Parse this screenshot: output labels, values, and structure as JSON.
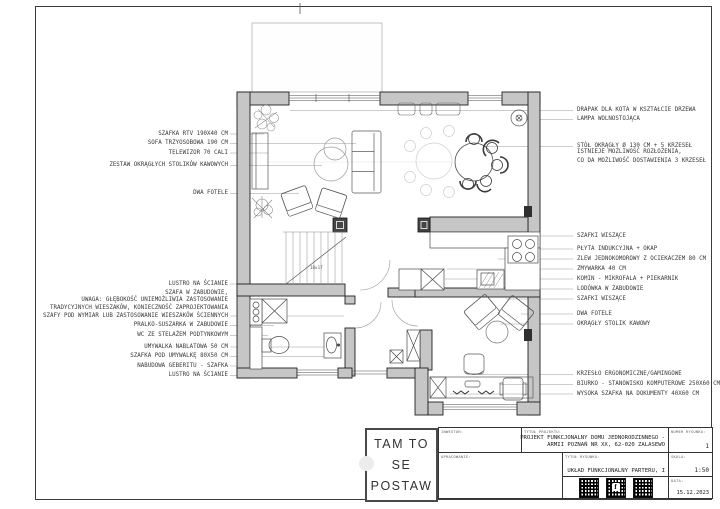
{
  "drawing": {
    "logo": [
      "TAM TO",
      "SE",
      "POSTAW"
    ],
    "stairs_note": "18x17",
    "qr_glyph": "f",
    "title_block": {
      "investor_label": "INWESTOR:",
      "development_label": "OPRACOWANIE:",
      "project_title_label": "TYTUŁ PROJEKTU:",
      "project_title_line1": "PROJEKT FUNKCJONALNY DOMU JEDNORODZINNEGO -",
      "project_title_line2": "ARMII POZNAŃ NR XX, 62-020 ZALASEWO",
      "drawing_title_label": "TYTUŁ RYSUNKU:",
      "drawing_title": "UKŁAD FUNKCJONALNY PARTERU, I",
      "number_label": "NUMER RYSUNKU:",
      "number": "1",
      "scale_label": "SKALA:",
      "scale": "1:50",
      "date_label": "DATA:",
      "date": "15.12.2023"
    },
    "annotations_left": [
      "SZAFKA RTV 190X40 CM",
      "SOFA TRZYOSOBOWA 190 CM",
      "TELEWIZOR 70 CALI",
      "ZESTAW OKRĄGŁYCH STOLIKÓW KAWOWYCH",
      "DWA FOTELE",
      "LUSTRO NA ŚCIANIE",
      "SZAFA W ZABUDOWIE,",
      "UWAGA: GŁĘBOKOŚĆ UNIEMOŻLIWIA ZASTOSOWANIE",
      "TRADYCYJNYCH WIESZAKÓW, KONIECZNOŚĆ ZAPROJEKTOWANIA",
      "SZAFY POD WYMIAR LUB ZASTOSOWANIE WIESZAKÓW ŚCIENNYCH",
      "PRALKO-SUSZARKA W ZABUDOWIE",
      "WC ZE STELAŻEM PODTYNKOWYM",
      "UMYWALKA NABLATOWA 50 CM",
      "SZAFKA POD UMYWALKĘ 80X50 CM",
      "NABUDOWA GEBERITU - SZAFKA",
      "LUSTRO NA ŚCIANIE"
    ],
    "annotations_right": [
      "DRAPAK DLA KOTA W KSZTAŁCIE DRZEWA",
      "LAMPA WOLNOSTOJĄCA",
      "STÓŁ OKRĄGŁY Ø 130 CM + 5 KRZESEŁ",
      "ISTNIEJE MOŻLIWOŚĆ ROZŁOŻENIA,",
      "CO DA MOŻLIWOŚĆ DOSTAWIENIA 3 KRZESEŁ",
      "SZAFKI WISZĄCE",
      "PŁYTA INDUKCYJNA + OKAP",
      "ZLEW JEDNOKOMOROWY Z OCIEKACZEM 80 CM",
      "ZMYWARKA 40 CM",
      "KOMIN - MIKROFALA + PIEKARNIK",
      "LODÓWKA W ZABUDOWIE",
      "SZAFKI WISZĄCE",
      "DWA FOTELE",
      "OKRĄGŁY STOLIK KAWOWY",
      "KRZESŁO ERGONOMICZNE/GAMINGOWE",
      "BIURKO - STANOWISKO KOMPUTEROWE 250X60 CM",
      "WYSOKA SZAFKA NA DOKUMENTY 40X60 CM"
    ]
  }
}
